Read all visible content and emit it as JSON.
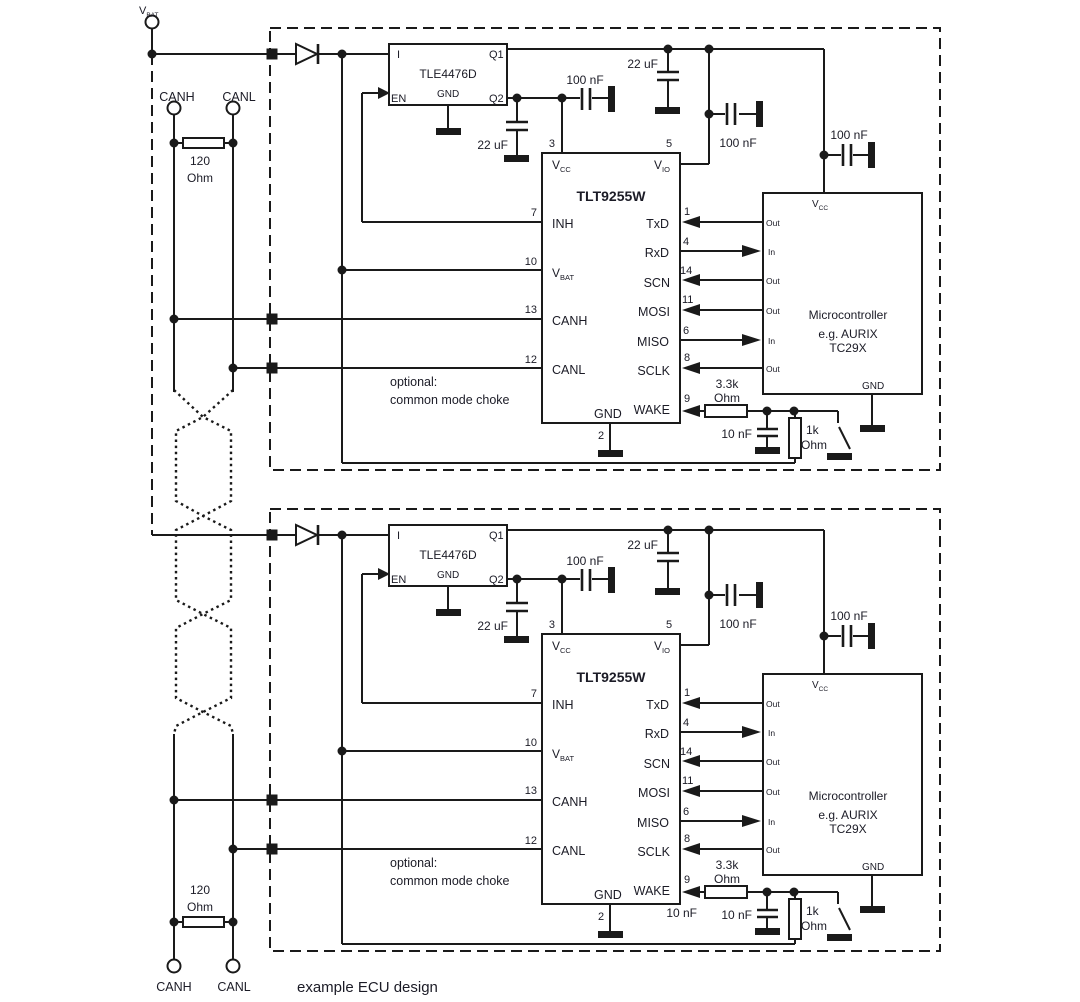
{
  "caption": "example ECU design",
  "colors": {
    "ink": "#1a1a1a",
    "text": "#1b1b26",
    "background": "#ffffff"
  },
  "bus": {
    "vbat_base": "V",
    "vbat_sub": "BAT",
    "canh_top": "CANH",
    "canl_top": "CANL",
    "term_top_value": "120",
    "term_top_unit": "Ohm",
    "term_bottom_value": "120",
    "term_bottom_unit": "Ohm",
    "canh_bottom": "CANH",
    "canl_bottom": "CANL"
  },
  "ecu": {
    "regulator": {
      "name": "TLE4476D",
      "pin_i": "I",
      "pin_q1": "Q1",
      "pin_en": "EN",
      "pin_gnd": "GND",
      "pin_q2": "Q2"
    },
    "transceiver": {
      "name": "TLT9255W",
      "vcc_base": "V",
      "vcc_sub": "CC",
      "vio_base": "V",
      "vio_sub": "IO",
      "vbat_base": "V",
      "vbat_sub": "BAT",
      "inh": "INH",
      "canh": "CANH",
      "canl": "CANL",
      "gnd": "GND",
      "txd": "TxD",
      "rxd": "RxD",
      "scn": "SCN",
      "mosi": "MOSI",
      "miso": "MISO",
      "sclk": "SCLK",
      "wake": "WAKE",
      "n1": "1",
      "n2": "2",
      "n3": "3",
      "n4": "4",
      "n5": "5",
      "n6": "6",
      "n7": "7",
      "n8": "8",
      "n9": "9",
      "n10": "10",
      "n11": "11",
      "n12": "12",
      "n13": "13",
      "n14": "14"
    },
    "micro": {
      "line1": "Microcontroller",
      "line2": "e.g. AURIX",
      "line3": "TC29X",
      "vcc_base": "V",
      "vcc_sub": "CC",
      "gnd": "GND",
      "out": "Out",
      "in": "In"
    },
    "passives": {
      "c22_q2": "22 uF",
      "c22_q1": "22 uF",
      "c100_vcc": "100 nF",
      "c100_vio": "100 nF",
      "c100_micro": "100 nF",
      "c10n": "10 nF",
      "r33k_value": "3.3k",
      "r33k_unit": "Ohm",
      "r1k_value": "1k",
      "r1k_unit": "Ohm"
    },
    "note_line1": "optional:",
    "note_line2": "common mode choke"
  },
  "ecu2_extra": {
    "stray_c10n": "10 nF"
  }
}
